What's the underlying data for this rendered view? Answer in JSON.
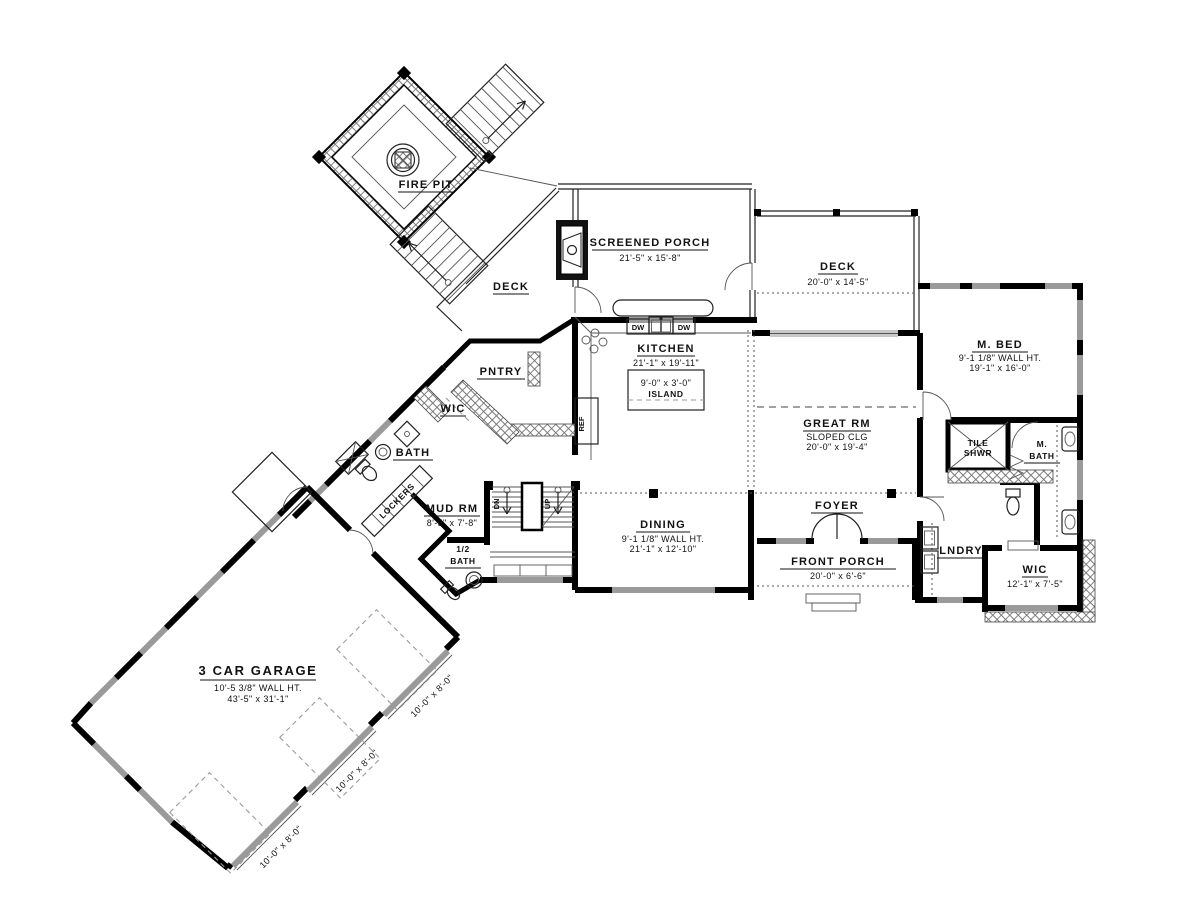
{
  "plan": {
    "title": "First floor plan",
    "colors": {
      "wall": "#000000",
      "window": "#9a9a9a",
      "hatch": "#666666",
      "paper": "#ffffff"
    },
    "labels": {
      "fire_pit": "FIRE PIT",
      "deck_upper": "DECK",
      "screened_porch": "SCREENED PORCH",
      "screened_porch_dim": "21'-5\" x 15'-8\"",
      "deck_right": "DECK",
      "deck_right_dim": "20'-0\" x 14'-5\"",
      "kitchen": "KITCHEN",
      "kitchen_dim": "21'-1\" x 19'-11\"",
      "island_dim": "9'-0\" x 3'-0\"",
      "island": "ISLAND",
      "great_rm": "GREAT RM",
      "great_rm_note": "SLOPED CLG",
      "great_rm_dim": "20'-0\" x 19'-4\"",
      "m_bed": "M. BED",
      "m_bed_note": "9'-1 1/8\" WALL HT.",
      "m_bed_dim": "19'-1\" x 16'-0\"",
      "tile_shwr_1": "TILE",
      "tile_shwr_2": "SHWR",
      "m_bath_1": "M.",
      "m_bath_2": "BATH",
      "pntry": "PNTRY",
      "wic": "WIC",
      "bath": "BATH",
      "lockers": "LOCKERS",
      "mud_rm": "MUD RM",
      "mud_rm_dim": "8'-5\" x 7'-8\"",
      "half_bath_1": "1/2",
      "half_bath_2": "BATH",
      "dn": "DN",
      "up": "UP",
      "ref": "REF",
      "dw": "DW",
      "dining": "DINING",
      "dining_note": "9'-1 1/8\" WALL HT.",
      "dining_dim": "21'-1\" x 12'-10\"",
      "foyer": "FOYER",
      "front_porch": "FRONT PORCH",
      "front_porch_dim": "20'-0\" x 6'-6\"",
      "lndry": "LNDRY",
      "m_wic": "WIC",
      "m_wic_dim": "12'-1\" x 7'-5\"",
      "garage": "3 CAR GARAGE",
      "garage_note": "10'-5 3/8\" WALL HT.",
      "garage_dim": "43'-5\" x 31'-1\"",
      "garage_door_dim": "10'-0\" x 8'-0\""
    }
  }
}
